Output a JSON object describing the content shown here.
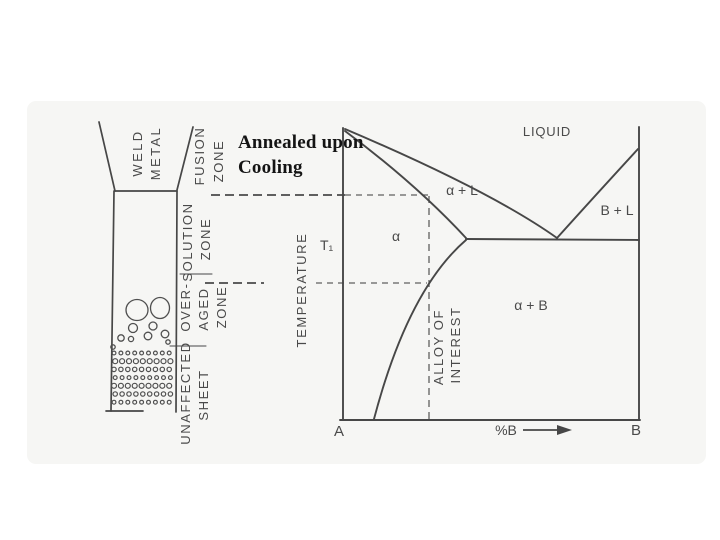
{
  "title": {
    "line1": "Annealed upon",
    "line2": "Cooling",
    "color": "#141414"
  },
  "figure": {
    "background": "#f6f6f4",
    "line_color": "#474747",
    "dash_color": "#5f5f5f",
    "label_color": "#4a4a4a",
    "weld_labels": {
      "weld_metal": [
        "WELD",
        "METAL"
      ],
      "fusion_zone": [
        "FUSION",
        "ZONE"
      ],
      "solution_zone": [
        "SOLUTION",
        "ZONE"
      ],
      "overaged_zone": [
        "OVER-",
        "AGED",
        "ZONE"
      ],
      "unaffected_sheet": [
        "UNAFFECTED",
        "SHEET"
      ]
    },
    "phase_labels": {
      "liquid": "LIQUID",
      "alpha_plus_l": "α + L",
      "b_plus_l": "B + L",
      "alpha": "α",
      "alpha_plus_b": "α + B",
      "t1": "T₁",
      "temperature": "TEMPERATURE",
      "alloy_line1": "ALLOY OF",
      "alloy_line2": "INTEREST",
      "axis_left": "A",
      "axis_right": "B",
      "axis_mid": "%B"
    },
    "microstructure": {
      "features": [
        [
          137,
          310,
          11,
          10.5
        ],
        [
          160,
          308,
          9.5,
          10.5
        ],
        [
          133,
          328,
          4.5,
          4.5
        ],
        [
          153,
          326,
          4,
          4
        ],
        [
          121,
          338,
          3.2,
          3.2
        ],
        [
          131,
          339,
          2.6,
          2.6
        ],
        [
          148,
          336,
          3.8,
          3.8
        ],
        [
          165,
          334,
          3.8,
          3.8
        ],
        [
          168,
          342,
          2.2,
          2.2
        ],
        [
          113,
          347,
          2.2,
          2.2
        ]
      ],
      "grid": {
        "x0": 114,
        "y0": 353,
        "dx": 6.9,
        "dy": 8.2,
        "cols": 9,
        "rows": 7,
        "r": 2.2
      }
    }
  }
}
